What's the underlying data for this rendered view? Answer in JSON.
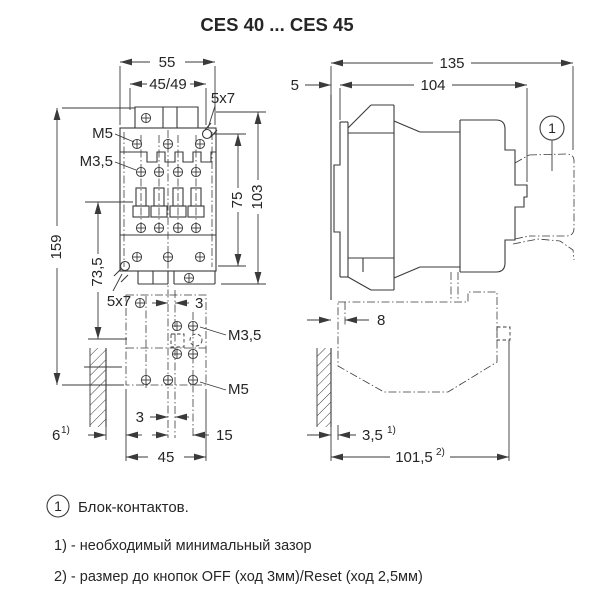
{
  "title": "CES 40 ... CES 45",
  "front_view": {
    "dim_width_outer": "55",
    "dim_width_inner": "45/49",
    "slot_size_top": "5x7",
    "label_m5_top": "M5",
    "label_m35_top": "M3,5",
    "dim_height_total": "159",
    "dim_height_aux": "73,5",
    "dim_height_slots": "75",
    "dim_height_body": "103",
    "slot_size_bottom": "5x7",
    "dim_offset_top": "3",
    "label_m35_aux": "M3,5",
    "label_m5_aux": "M5",
    "dim_offset_bottom": "3",
    "dim_clearance": "6",
    "dim_clearance_sup": "1)",
    "dim_aux_right": "15",
    "dim_aux_width": "45"
  },
  "side_view": {
    "dim_depth_total": "135",
    "dim_depth_body": "104",
    "dim_rail_offset": "5",
    "dim_clearance_top": "8",
    "dim_clearance_bottom": "3,5",
    "dim_clearance_bottom_sup": "1)",
    "dim_removal": "101,5",
    "dim_removal_sup": "2)",
    "callout_marker": "1"
  },
  "legend": {
    "marker": "1",
    "text": "Блок-контактов."
  },
  "notes": {
    "note1": "1) - необходимый минимальный зазор",
    "note2": "2) - размер до кнопок OFF (ход 3мм)/Reset (ход 2,5мм)"
  }
}
